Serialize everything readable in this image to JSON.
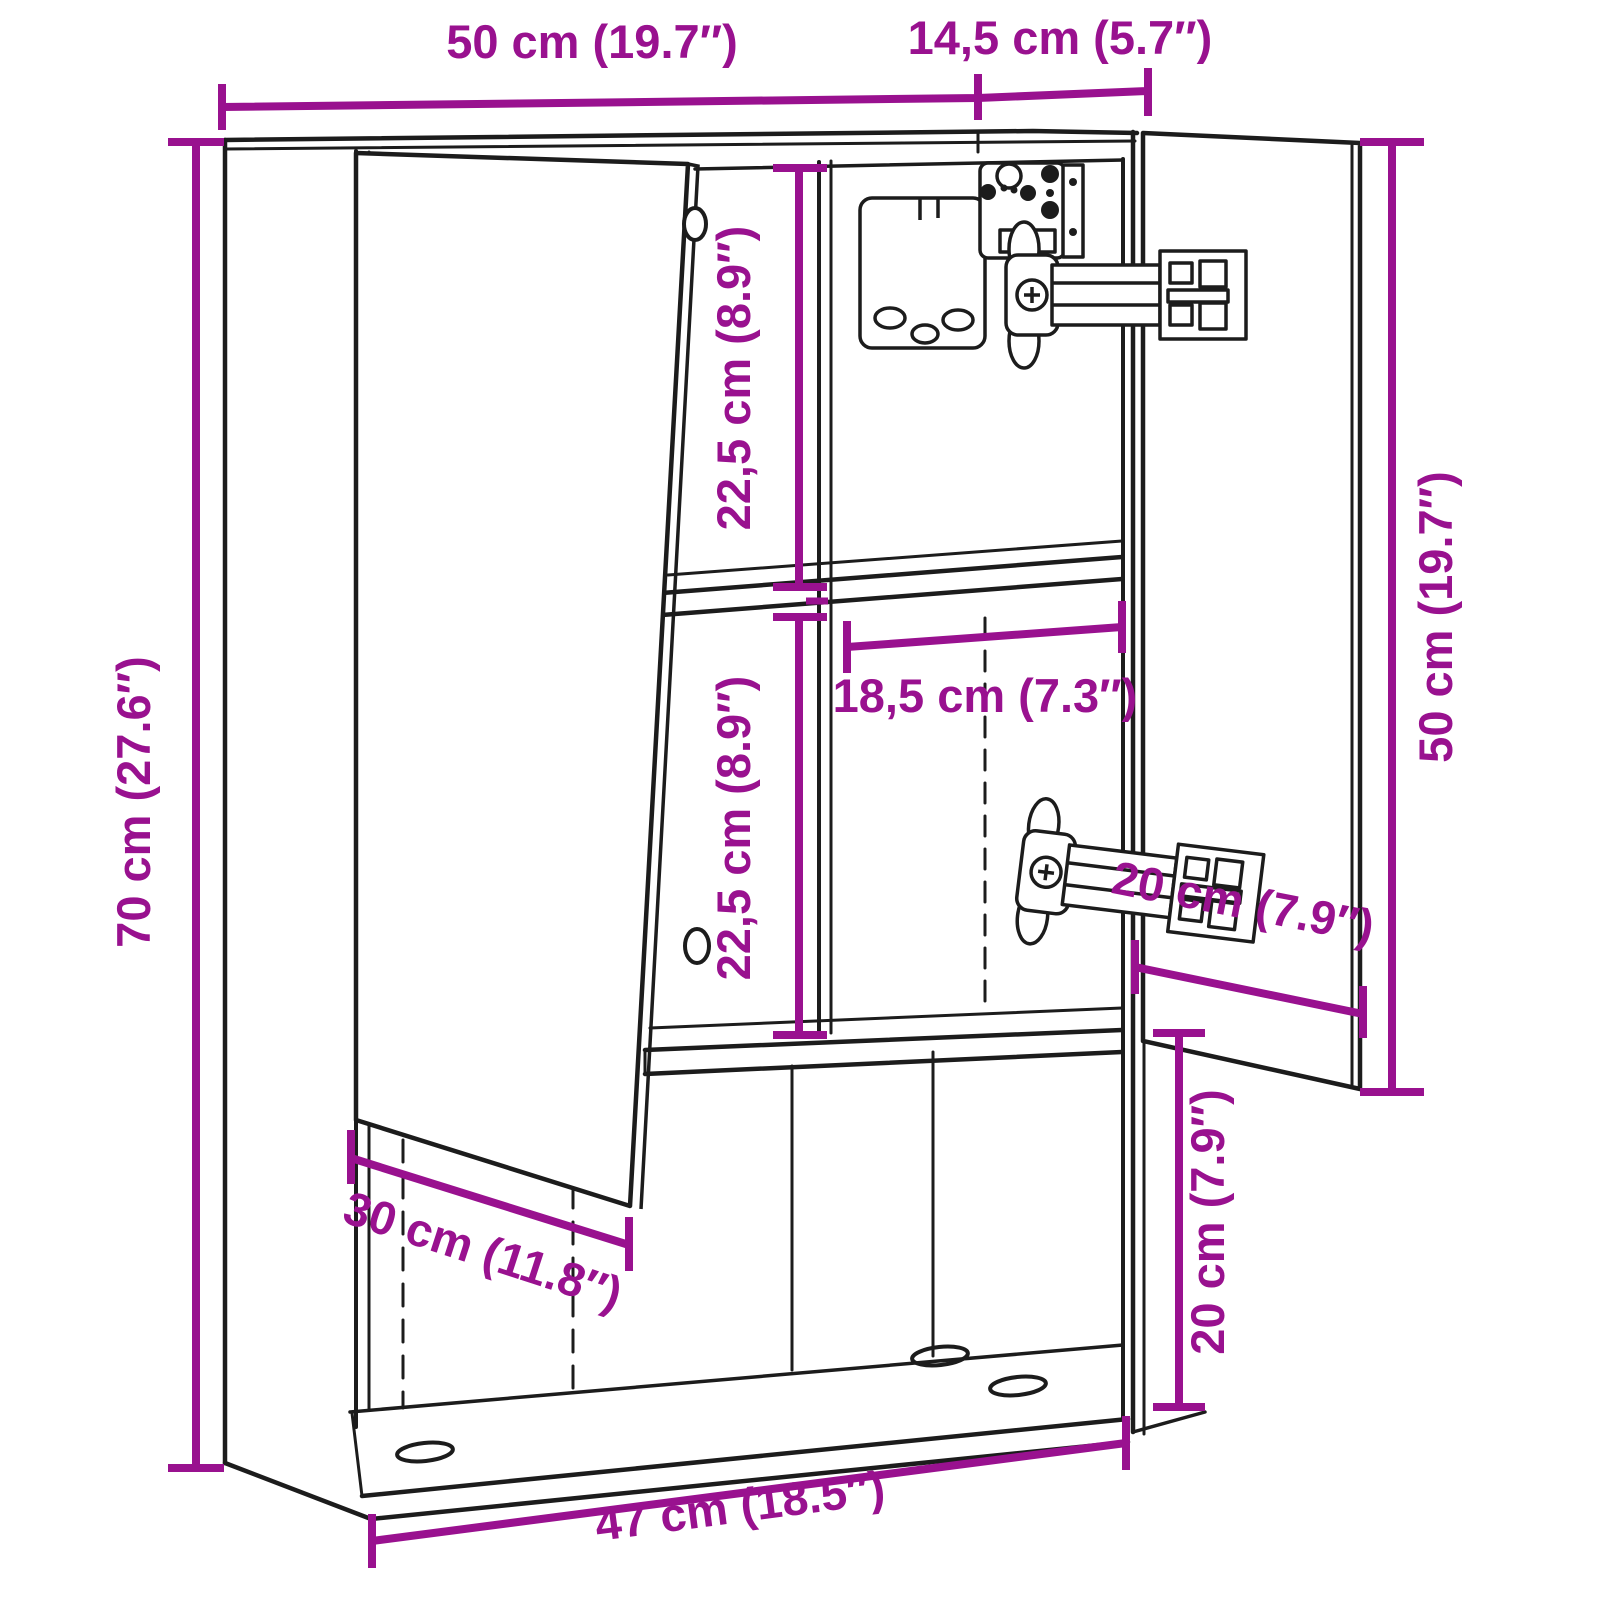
{
  "drawing": {
    "type": "furniture-dimension-diagram",
    "background": "#FFFFFF",
    "line_color": "#1C1C1C",
    "dimension_color": "#99118F",
    "dimensions": {
      "top_width": "50 cm (19.7″)",
      "top_depth": "14,5 cm (5.7″)",
      "left_height": "70 cm (27.6″)",
      "upper_inner_height": "22,5 cm (8.9″)",
      "lower_inner_height": "22,5 cm (8.9″)",
      "inner_width": "18,5 cm (7.3″)",
      "right_door_height": "50 cm (19.7″)",
      "right_door_width": "20 cm (7.9″)",
      "bottom_section_height": "20 cm (7.9″)",
      "left_door_width": "30 cm (11.8″)",
      "bottom_inner_width": "47 cm (18.5″)"
    }
  }
}
